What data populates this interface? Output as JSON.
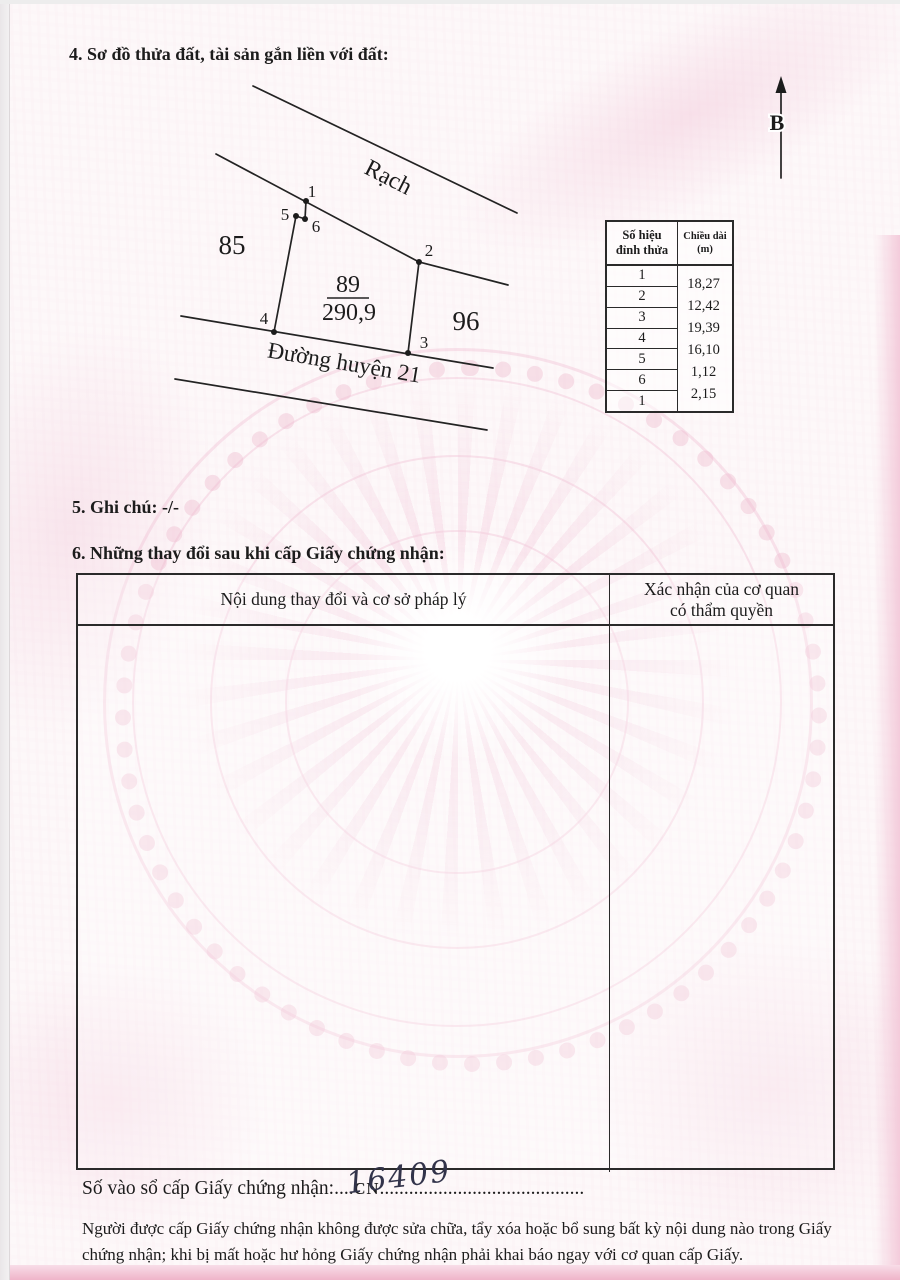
{
  "page": {
    "section4_title": "4. Sơ đồ thửa đất, tài sản gắn liền với đất:",
    "section5_title": "5. Ghi chú: -/-",
    "section6_title": "6. Những thay đổi sau khi cấp Giấy chứng nhận:"
  },
  "diagram": {
    "north_label": "B",
    "canal_label": "Rạch",
    "road_label": "Đường huyện 21",
    "left_parcel_number": "85",
    "right_parcel_number": "96",
    "parcel_number": "89",
    "parcel_area": "290,9",
    "vertex_labels": {
      "v1": "1",
      "v2": "2",
      "v3": "3",
      "v4": "4",
      "v5": "5",
      "v6": "6"
    }
  },
  "vertex_table": {
    "col1_header_line1": "Số hiệu",
    "col1_header_line2": "đỉnh thửa",
    "col2_header_line1": "Chiều dài",
    "col2_header_line2": "(m)",
    "vertex_numbers": [
      "1",
      "2",
      "3",
      "4",
      "5",
      "6",
      "1"
    ],
    "lengths": [
      "18,27",
      "12,42",
      "19,39",
      "16,10",
      "1,12",
      "2,15"
    ]
  },
  "changes_table": {
    "col1_header": "Nội dung thay đổi và cơ sở pháp lý",
    "col2_header_line1": "Xác nhận của cơ quan",
    "col2_header_line2": "có thẩm quyền"
  },
  "registry": {
    "label": "Số vào sổ cấp Giấy chứng nhận:",
    "dots_before": "....",
    "code": "CN",
    "dots_after": "..........................................",
    "handwritten_number": "16409"
  },
  "footer_note": "Người được cấp Giấy chứng nhận không được sửa chữa, tẩy xóa hoặc bổ sung bất kỳ nội dung nào trong Giấy chứng nhận; khi bị mất hoặc hư hỏng Giấy chứng nhận phải khai báo ngay với cơ quan cấp Giấy.",
  "colors": {
    "ink": "#1c1c1c",
    "paper": "#fdf8f9",
    "pink_band": "#efb4c9",
    "watermark_pink": "#f3cadb"
  }
}
